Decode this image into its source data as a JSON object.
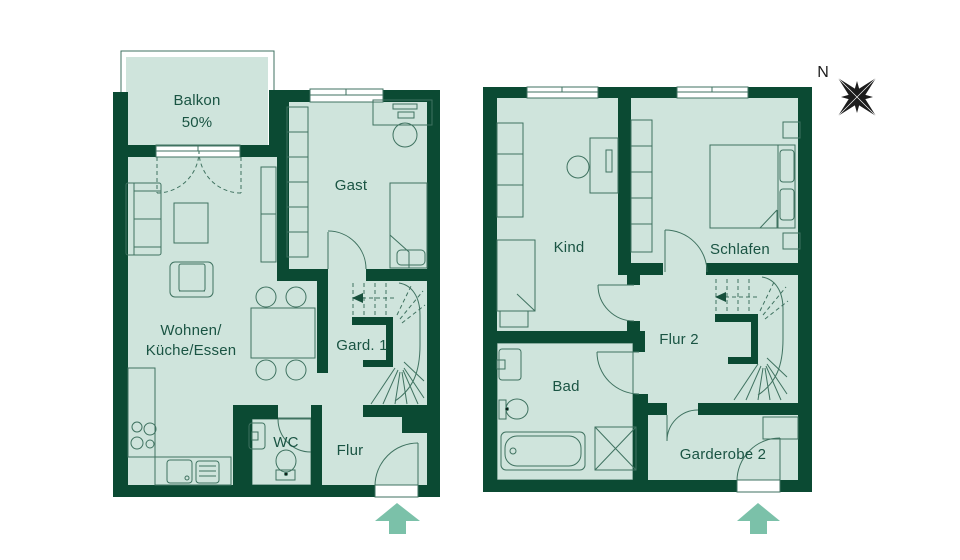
{
  "title": "Wohnungsgrundriss Maisonette",
  "colors": {
    "wall": "#0b4a33",
    "floor": "#cfe4dc",
    "line": "#3f7260",
    "tile_line": "#bcd7cb",
    "arrow": "#7bc1a9",
    "compass": "#1c1c1c",
    "text": "#1a5443",
    "white": "#ffffff"
  },
  "compass": {
    "north_label": "N"
  },
  "entrance_arrows": [
    {
      "name": "entrance-arrow-lower-level"
    },
    {
      "name": "entrance-arrow-upper-level"
    }
  ],
  "plans": [
    {
      "id": "plan-lower",
      "labels": {
        "balkon_line1": "Balkon",
        "balkon_line2": "50%",
        "gast": "Gast",
        "wohnen_line1": "Wohnen/",
        "wohnen_line2": "Küche/Essen",
        "gard1": "Gard. 1",
        "wc": "WC",
        "flur": "Flur"
      }
    },
    {
      "id": "plan-upper",
      "labels": {
        "kind": "Kind",
        "schlafen": "Schlafen",
        "flur2": "Flur 2",
        "bad": "Bad",
        "garderobe2": "Garderobe 2"
      }
    }
  ]
}
